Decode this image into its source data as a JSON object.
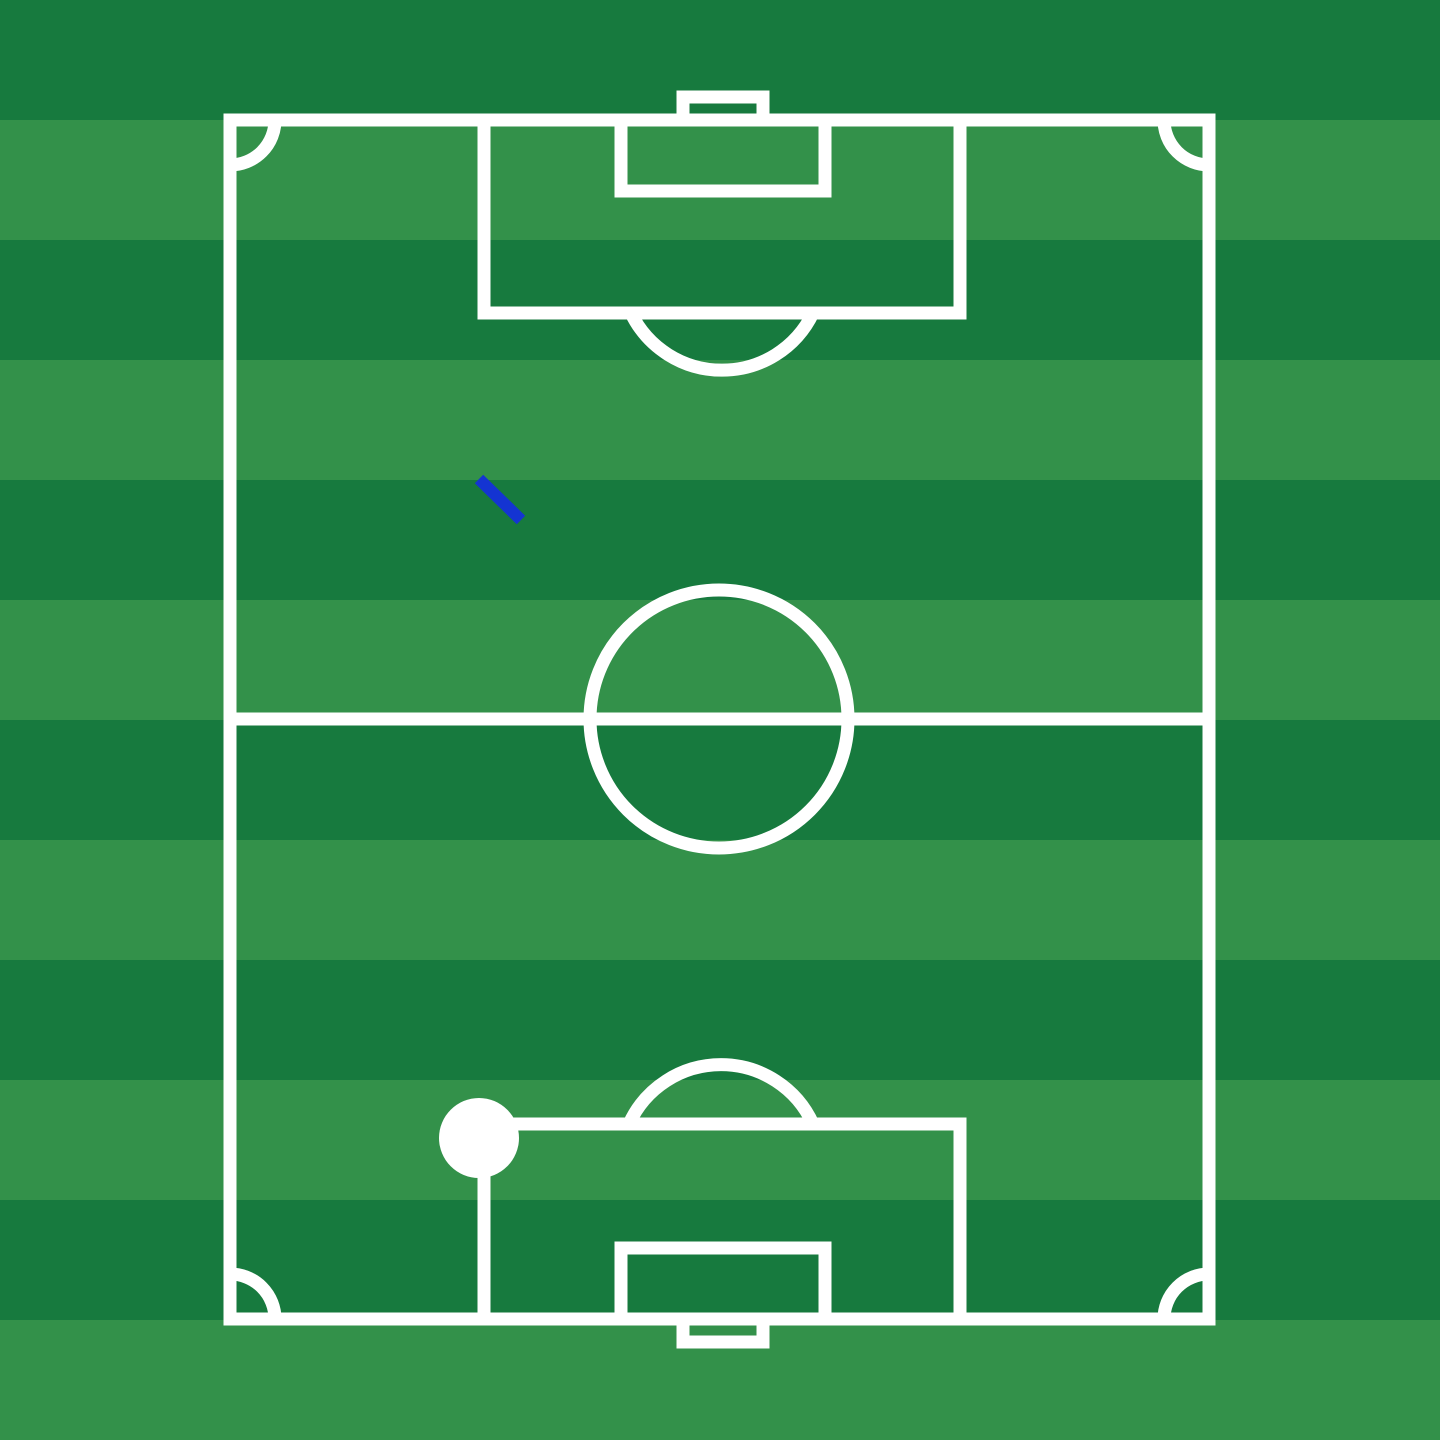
{
  "scene": {
    "title": "Soccer pitch tactics board",
    "canvas": {
      "width": 1440,
      "height": 1440
    }
  },
  "colors": {
    "stripe_dark": "#177A3E",
    "stripe_light": "#33914A",
    "line": "#FFFFFF",
    "marker": "#FFFFFF",
    "annotation": "#1434D2"
  },
  "stripes": {
    "count": 12,
    "height": 120,
    "orientation": "horizontal",
    "first_shade": "dark"
  },
  "pitch": {
    "line_width": 13,
    "outline": {
      "x": 230,
      "y": 120,
      "width": 979,
      "height": 1199
    },
    "halfway_line": {
      "x1": 230,
      "y1": 719,
      "x2": 1209,
      "y2": 719
    },
    "center_circle": {
      "cx": 719,
      "cy": 719,
      "r": 129
    },
    "penalty_area_top": {
      "x": 484,
      "y": 120,
      "width": 476,
      "height": 193
    },
    "goal_area_top": {
      "x": 621,
      "y": 120,
      "width": 204,
      "height": 71
    },
    "goal_top": {
      "x": 683,
      "y": 97,
      "width": 80,
      "height": 23
    },
    "penalty_arc_top": {
      "d": "M 631 313 A 101 101 0 0 0 813 313"
    },
    "penalty_area_bottom": {
      "x": 484,
      "y": 1124,
      "width": 476,
      "height": 195
    },
    "goal_area_bottom": {
      "x": 621,
      "y": 1248,
      "width": 204,
      "height": 71
    },
    "goal_bottom": {
      "x": 683,
      "y": 1319,
      "width": 80,
      "height": 23
    },
    "penalty_arc_bottom": {
      "d": "M 629 1124 A 101 101 0 0 1 813 1124"
    },
    "corner_arcs": [
      {
        "d": "M 230 165 A 45 45 0 0 0 275 120"
      },
      {
        "d": "M 1164 120 A 45 45 0 0 0 1209 165"
      },
      {
        "d": "M 1209 1274 A 45 45 0 0 0 1164 1319"
      },
      {
        "d": "M 275 1319 A 45 45 0 0 0 230 1274"
      }
    ]
  },
  "annotations": {
    "movement_line": {
      "x1": 479,
      "y1": 479,
      "x2": 521,
      "y2": 520,
      "stroke-width": 12
    },
    "marker": {
      "cx": 479,
      "cy": 1138,
      "r": 40
    }
  }
}
